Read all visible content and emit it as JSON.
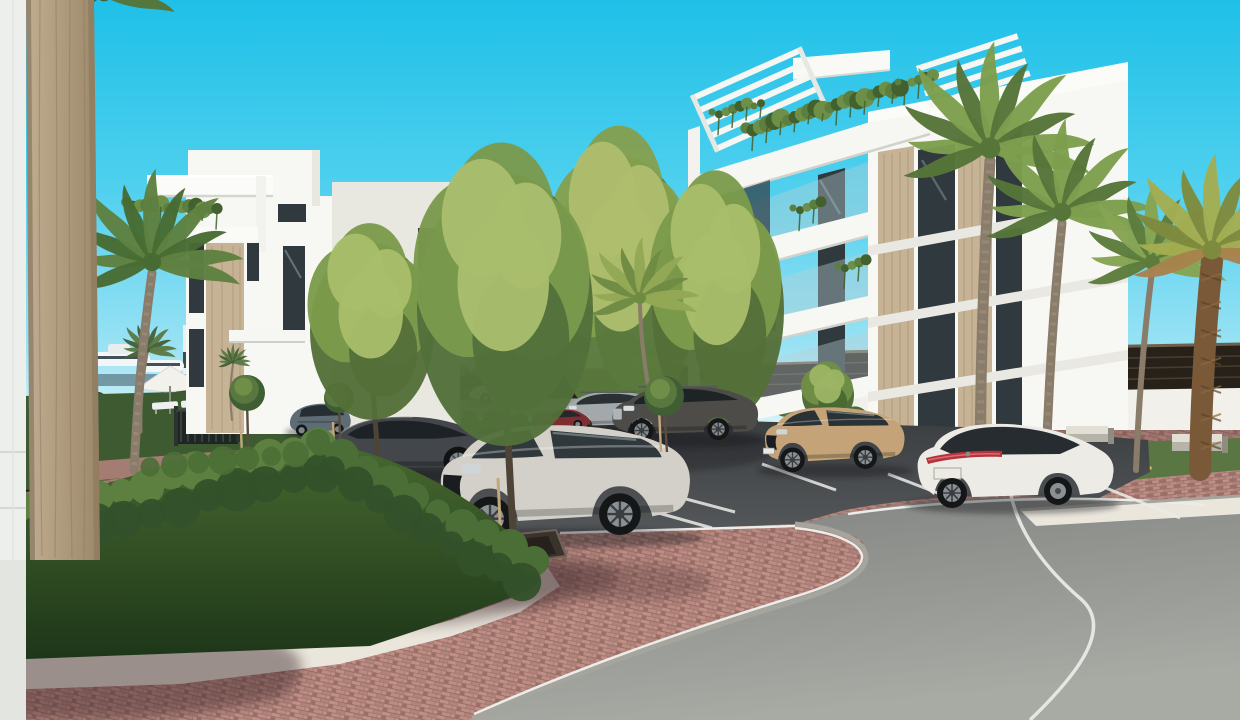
{
  "scene": {
    "title": "apartment-complex-rendering",
    "description": "3D architectural rendering of a modern white apartment complex with palm trees, landscaped parking with parked cars, red paver walkways and a curved asphalt road under a clear cyan sky.",
    "palette": {
      "skyTop": "#1fc0e8",
      "skyMid": "#4fd0ee",
      "skyLow": "#9ae2f4",
      "skyHorizon": "#e6f7fa",
      "mountain": "#bcd2de",
      "cityWhite": "#e9edee",
      "citySlate": "#5f7184",
      "cityShadow": "#c2ccd1",
      "cityBase": "#3d4854",
      "fenceDark": "#27211a",
      "fenceGap": "#4e4234",
      "fenceCap": "#6e604c",
      "wallWhite": "#f1f0ea",
      "wallShade": "#d8d5cb",
      "bgRoad": "#9aa09e",
      "hedgeDark": "#22381e",
      "hedgeMid": "#33512a",
      "hedgeLight": "#4b6e36",
      "hedgeTop": "#5d8040",
      "bgTree": "#4f6f46",
      "grassGarden": "#3d5a31",
      "grassRight": "#5a7743",
      "paverLine": "#9a6f68",
      "paverA": "#c09086",
      "paverB": "#b0837b",
      "paverC": "#bb8d84",
      "pathPaver": "#aa7e75",
      "gravel": "#eae6dc",
      "asphaltTop": "#3c3f41",
      "asphaltBot": "#585b5d",
      "roadA": "#7f827f",
      "roadB": "#a8aaa4",
      "curb": "#a5a59d",
      "lineWhite": "#ecece8",
      "colTanA": "#c0ad90",
      "colTanB": "#9c8769",
      "colStreak": "#8f7b5e",
      "bldWhite": "#f7f7f3",
      "bldShade": "#e8e7e0",
      "bldTan": "#c6b295",
      "bldTanStreak": "#b09a79",
      "winDark": "#2f393e",
      "winRefl": "#c9dde2",
      "glassRail": "#b8cfd4",
      "plant": "#5c7f40",
      "plantDark": "#42612e",
      "trunk": "#8a7c6a",
      "trunkDark": "#5d5244",
      "stake": "#c2a87c"
    },
    "cars": [
      {
        "name": "car-background-silver",
        "sym": "carSmall",
        "layer": "back",
        "x": 466,
        "y": 372,
        "s": 0.55,
        "body": "#c6cac9",
        "glass": "#3a4347"
      },
      {
        "name": "car-hatchback-blue",
        "sym": "hatch",
        "layer": "main",
        "x": 286,
        "y": 398,
        "s": 0.52,
        "body": "#5e6c76",
        "glass": "#262d33"
      },
      {
        "name": "car-sedan-dark",
        "sym": "sedanSide",
        "layer": "main",
        "x": 288,
        "y": 404,
        "s": 0.99,
        "body": "#43474b",
        "glass": "#1d2226"
      },
      {
        "name": "car-suv-silver",
        "sym": "suvSide",
        "layer": "main",
        "x": 558,
        "y": 386,
        "s": 0.52,
        "body": "#a3a8aa",
        "glass": "#2a3135"
      },
      {
        "name": "car-compact-red",
        "sym": "carSmall",
        "layer": "main",
        "x": 532,
        "y": 404,
        "s": 0.44,
        "body": "#7e2d31",
        "glass": "#22282c"
      },
      {
        "name": "car-suv-dark",
        "sym": "suvSide",
        "layer": "main",
        "x": 608,
        "y": 378,
        "s": 0.73,
        "body": "#4d4c49",
        "glass": "#1e2326"
      },
      {
        "name": "car-suv-tan",
        "sym": "suvFront34",
        "layer": "main",
        "x": 760,
        "y": 400,
        "s": 0.65,
        "body": "#c3a377",
        "glass": "#2b3236"
      },
      {
        "name": "car-sedan-white",
        "sym": "sedanRear34",
        "layer": "main",
        "x": 910,
        "y": 413,
        "s": 1.0,
        "body": "#ecebe6",
        "glass": "#262c30"
      },
      {
        "name": "car-suv-white",
        "sym": "suvFront34",
        "layer": "main",
        "x": 432,
        "y": 412,
        "s": 1.16,
        "body": "#d3d0c9",
        "glass": "#30383c"
      }
    ],
    "palms": [
      {
        "name": "palm-sapling-garden",
        "cx": 147,
        "cy": 350,
        "r": 30,
        "light": "#5b7a45",
        "dark": "#46603a",
        "trunk": {
          "x": 141,
          "y": 432,
          "w": 3
        }
      },
      {
        "name": "palm-background-small",
        "cx": 233,
        "cy": 362,
        "r": 18,
        "light": "#5b7a45",
        "dark": "#46603a",
        "trunk": {
          "x": 232,
          "y": 420,
          "w": 2
        }
      },
      {
        "name": "palm-left-tall",
        "cx": 152,
        "cy": 262,
        "r": 92,
        "light": "#5e8040",
        "dark": "#486b33",
        "trunk": {
          "x": 134,
          "y": 470,
          "w": 9
        }
      },
      {
        "name": "palm-top-left-fronds",
        "cx": 104,
        "cy": -6,
        "r": 74,
        "light": "#557537",
        "dark": "#44602c"
      },
      {
        "name": "palm-center-slim",
        "cx": 640,
        "cy": 298,
        "r": 60,
        "light": "#93a855",
        "dark": "#6f8a43",
        "trunk": {
          "x": 650,
          "y": 396,
          "w": 4
        }
      },
      {
        "name": "palm-right-big",
        "cx": 990,
        "cy": 148,
        "r": 105,
        "light": "#7d9e4d",
        "dark": "#567539",
        "trunk": {
          "x": 980,
          "y": 464,
          "w": 11
        }
      },
      {
        "name": "palm-right-second",
        "cx": 1062,
        "cy": 212,
        "r": 92,
        "light": "#7d9e4d",
        "dark": "#567539",
        "trunk": {
          "x": 1046,
          "y": 466,
          "w": 9
        }
      },
      {
        "name": "palm-right-leaning",
        "cx": 1152,
        "cy": 262,
        "r": 78,
        "light": "#86a452",
        "dark": "#5d7c3c",
        "trunk": {
          "x": 1136,
          "y": 470,
          "w": 6
        }
      },
      {
        "name": "palm-date-far-right",
        "cx": 1212,
        "cy": 250,
        "r": 95,
        "light": "#a3ad52",
        "dark": "#7e8a3e",
        "date": true,
        "trunk": {
          "x": 1200,
          "y": 470,
          "w": 22,
          "c": "#7a5938"
        }
      }
    ],
    "treesBack": [
      {
        "name": "tree-center-a",
        "cx": 622,
        "cy": 276,
        "rx": 74,
        "ry": 146,
        "light": "#aebd6d",
        "mid": "#84a04f",
        "dark": "#5b7a3d",
        "trunk": {
          "x": 626,
          "y": 462,
          "w": 6
        }
      },
      {
        "name": "tree-center-b",
        "cx": 718,
        "cy": 298,
        "rx": 66,
        "ry": 124,
        "light": "#a8bd6a",
        "mid": "#7c9b4b",
        "dark": "#546f38",
        "trunk": {
          "x": 722,
          "y": 446,
          "w": 5
        }
      },
      {
        "name": "tree-behind-tan-suv",
        "cx": 828,
        "cy": 392,
        "rx": 26,
        "ry": 30,
        "light": "#9cb464",
        "mid": "#6f8f46",
        "dark": "#4a6832",
        "trunk": {
          "x": 829,
          "y": 443,
          "w": 3
        }
      }
    ],
    "treesFront": [
      {
        "name": "tree-over-dark-sedan",
        "cx": 372,
        "cy": 322,
        "rx": 62,
        "ry": 96,
        "light": "#a8bd6a",
        "mid": "#7c9b4b",
        "dark": "#546f38",
        "trunk": {
          "x": 379,
          "y": 468,
          "w": 5
        }
      },
      {
        "name": "tree-foreground-main",
        "cx": 505,
        "cy": 295,
        "rx": 88,
        "ry": 148,
        "light": "#a9bd6d",
        "mid": "#7a9a4c",
        "dark": "#52703a",
        "trunk": {
          "x": 514,
          "y": 548,
          "w": 7
        },
        "stake": true
      }
    ],
    "saplings": [
      {
        "name": "sapling-staked-1",
        "cx": 247,
        "cy": 393,
        "r": 18,
        "tx": 249,
        "ty": 476,
        "stake": true
      },
      {
        "name": "sapling-staked-2",
        "cx": 339,
        "cy": 398,
        "r": 15,
        "tx": 341,
        "ty": 466,
        "stake": true
      },
      {
        "name": "sapling-staked-3",
        "cx": 664,
        "cy": 396,
        "r": 20,
        "tx": 667,
        "ty": 452,
        "stake": true
      }
    ],
    "benches": [
      {
        "name": "stone-bench-1",
        "x": 1066,
        "y": 426,
        "w": 42,
        "h": 16,
        "d": 6
      },
      {
        "name": "stone-bench-2",
        "x": 1172,
        "y": 434,
        "w": 50,
        "h": 17,
        "d": 6
      }
    ],
    "stallLines": [
      [
        358,
        468,
        432,
        490
      ],
      [
        652,
        490,
        735,
        512
      ],
      [
        762,
        464,
        836,
        490
      ],
      [
        888,
        474,
        956,
        500
      ],
      [
        1106,
        488,
        1180,
        518
      ],
      [
        430,
        533,
        490,
        547
      ],
      [
        655,
        512,
        712,
        528
      ]
    ],
    "bumpRows": [
      {
        "layer": "bgtrees",
        "x1": 850,
        "y1": 374,
        "x2": 1235,
        "y2": 364,
        "n": 17,
        "r": 8,
        "c": "bgTree",
        "o": 0.95
      },
      {
        "layer": "bgtrees",
        "x1": 424,
        "y1": 372,
        "x2": 560,
        "y2": 368,
        "n": 8,
        "r": 7,
        "c": "bgTree",
        "o": 0.9
      },
      {
        "layer": "bghedge",
        "x1": 30,
        "y1": 408,
        "x2": 228,
        "y2": 398,
        "n": 10,
        "r": 11,
        "c": "hedgeMid",
        "o": 1
      },
      {
        "layer": "bghedge",
        "x1": 228,
        "y1": 404,
        "x2": 466,
        "y2": 428,
        "n": 11,
        "r": 13,
        "c": "hedgeLight",
        "o": 1
      },
      {
        "layer": "bghedge",
        "x1": 470,
        "y1": 422,
        "x2": 838,
        "y2": 436,
        "n": 16,
        "r": 11,
        "c": "hedgeMid",
        "o": 1
      },
      {
        "layer": "bghedge",
        "x1": 784,
        "y1": 410,
        "x2": 902,
        "y2": 428,
        "n": 6,
        "r": 12,
        "c": "hedgeLight",
        "o": 1
      },
      {
        "layer": "rbhedge",
        "x1": 694,
        "y1": 452,
        "x2": 900,
        "y2": 438,
        "n": 11,
        "r": 13,
        "c": "hedgeMid",
        "o": 1
      },
      {
        "layer": "rbhedge",
        "x1": 694,
        "y1": 464,
        "x2": 882,
        "y2": 452,
        "n": 9,
        "r": 12,
        "c": "hedgeDark",
        "o": 0.95
      },
      {
        "layer": "hedgebumps",
        "x1": 0,
        "y1": 518,
        "x2": 318,
        "y2": 444,
        "n": 14,
        "r": 16,
        "c": "hedgeTop",
        "o": 1
      },
      {
        "layer": "hedgebumps",
        "x1": 10,
        "y1": 544,
        "x2": 322,
        "y2": 472,
        "n": 12,
        "r": 18,
        "c": "hedgeMid",
        "o": 0.95
      },
      {
        "layer": "hedgebumps",
        "x1": 150,
        "y1": 470,
        "x2": 320,
        "y2": 448,
        "n": 8,
        "r": 12,
        "c": "hedgeLight",
        "o": 0.9
      },
      {
        "layer": "hedgebumps",
        "x1": 318,
        "y1": 444,
        "x2": 534,
        "y2": 562,
        "n": 10,
        "r": 15,
        "c": "hedgeLight",
        "o": 1
      },
      {
        "layer": "hedgebumps",
        "x1": 332,
        "y1": 472,
        "x2": 522,
        "y2": 584,
        "n": 9,
        "r": 16,
        "c": "hedgeMid",
        "o": 0.95
      }
    ],
    "cascades": [
      {
        "x": 126,
        "y": 204,
        "w": 104,
        "slope": 0.05,
        "size": 7
      },
      {
        "x": 746,
        "y": 130,
        "w": 162,
        "slope": -0.28,
        "size": 8
      },
      {
        "x": 696,
        "y": 248,
        "w": 64,
        "slope": -0.24,
        "size": 6
      },
      {
        "x": 722,
        "y": 322,
        "w": 58,
        "slope": -0.22,
        "size": 6
      },
      {
        "x": 793,
        "y": 210,
        "w": 36,
        "slope": -0.26,
        "size": 5
      },
      {
        "x": 838,
        "y": 268,
        "w": 40,
        "slope": -0.26,
        "size": 5
      },
      {
        "x": 898,
        "y": 84,
        "w": 46,
        "slope": -0.2,
        "size": 5
      },
      {
        "x": 712,
        "y": 114,
        "w": 62,
        "slope": -0.24,
        "size": 5
      }
    ]
  }
}
